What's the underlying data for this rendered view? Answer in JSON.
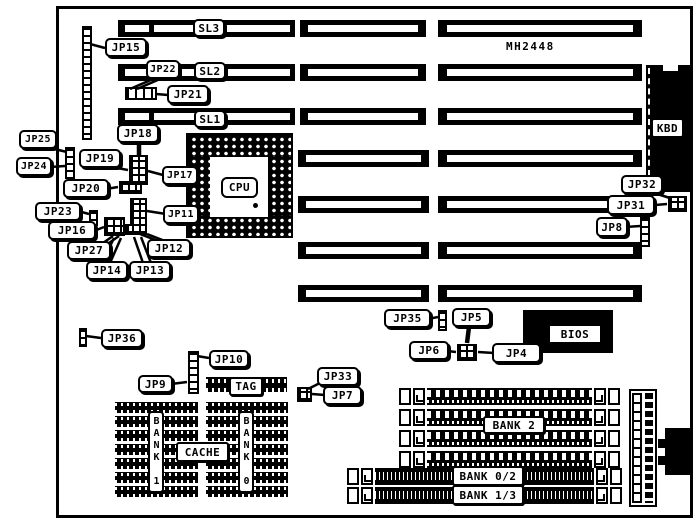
{
  "board": {
    "model": "MH2448"
  },
  "slots": {
    "sl1": {
      "label": "SL1"
    },
    "sl2": {
      "label": "SL2"
    },
    "sl3": {
      "label": "SL3"
    }
  },
  "jumpers": {
    "jp4": {
      "label": "JP4"
    },
    "jp5": {
      "label": "JP5"
    },
    "jp6": {
      "label": "JP6"
    },
    "jp7": {
      "label": "JP7"
    },
    "jp8": {
      "label": "JP8"
    },
    "jp9": {
      "label": "JP9"
    },
    "jp10": {
      "label": "JP10"
    },
    "jp11": {
      "label": "JP11"
    },
    "jp12": {
      "label": "JP12"
    },
    "jp13": {
      "label": "JP13"
    },
    "jp14": {
      "label": "JP14"
    },
    "jp15": {
      "label": "JP15"
    },
    "jp16": {
      "label": "JP16"
    },
    "jp17": {
      "label": "JP17"
    },
    "jp18": {
      "label": "JP18"
    },
    "jp19": {
      "label": "JP19"
    },
    "jp20": {
      "label": "JP20"
    },
    "jp21": {
      "label": "JP21"
    },
    "jp22": {
      "label": "JP22"
    },
    "jp23": {
      "label": "JP23"
    },
    "jp24": {
      "label": "JP24"
    },
    "jp25": {
      "label": "JP25"
    },
    "jp27": {
      "label": "JP27"
    },
    "jp31": {
      "label": "JP31"
    },
    "jp32": {
      "label": "JP32"
    },
    "jp33": {
      "label": "JP33"
    },
    "jp35": {
      "label": "JP35"
    },
    "jp36": {
      "label": "JP36"
    }
  },
  "components": {
    "cpu": {
      "label": "CPU"
    },
    "kbd": {
      "label": "KBD"
    },
    "bios": {
      "label": "BIOS"
    },
    "tag": {
      "label": "TAG"
    },
    "cache": {
      "label": "CACHE"
    }
  },
  "memory": {
    "bank1": {
      "label": "BANK 1"
    },
    "bank0": {
      "label": "BANK 0"
    },
    "bank2": {
      "label": "BANK 2"
    },
    "bank02": {
      "label": "BANK 0/2"
    },
    "bank13": {
      "label": "BANK 1/3"
    }
  }
}
